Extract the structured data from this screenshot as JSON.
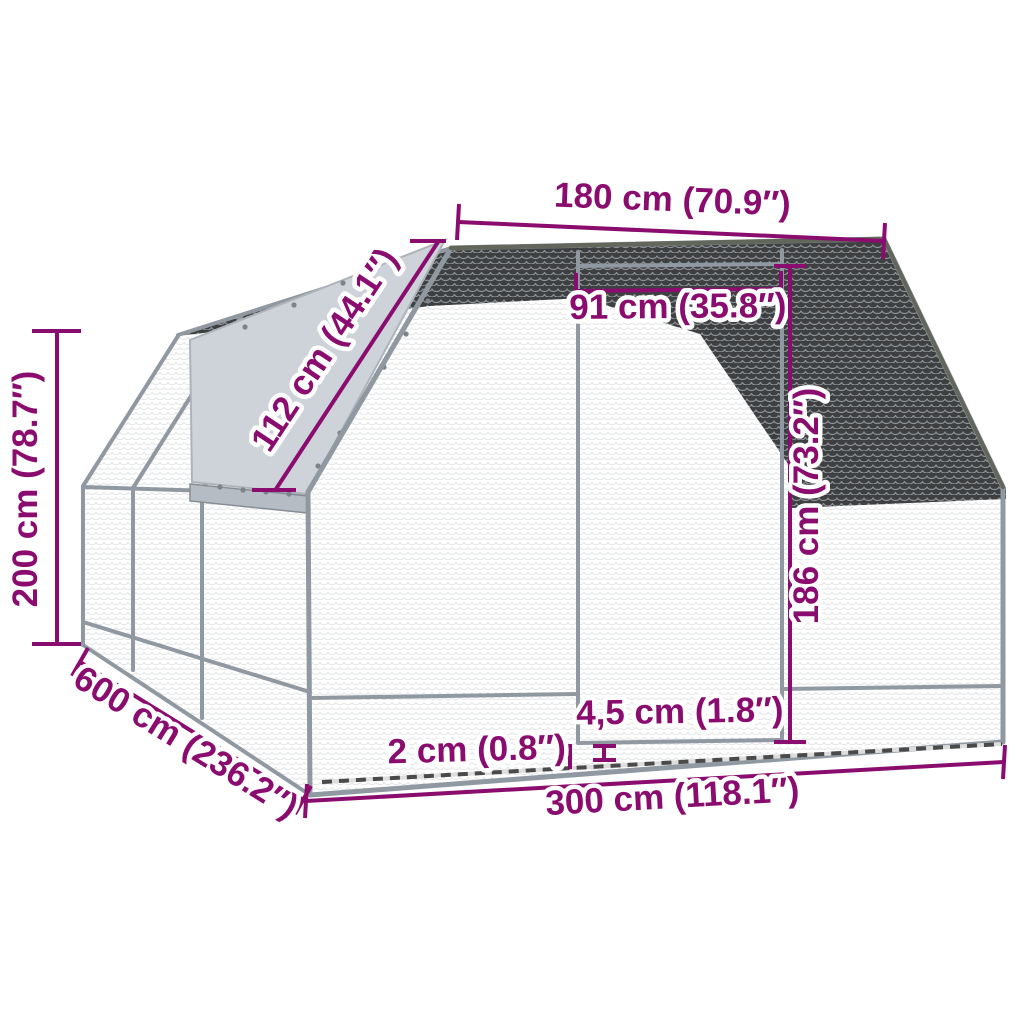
{
  "page": {
    "background": "#ffffff"
  },
  "diagram": {
    "subject": "outdoor chicken cage dimension drawing",
    "colors": {
      "accent": "#8A0C6E",
      "halo": "#ffffff",
      "frame": "#9099A1",
      "frame_dark": "#63665A",
      "roof_mesh": "#3E3F41",
      "roof_mesh_highlight": "#9aa0a4",
      "wall_mesh_line": "#e3e5e7",
      "tarp": "#ced3da",
      "tarp_rail": "#b6bcc4",
      "interior": "#c6cacd"
    },
    "dimensions": {
      "top_width": "180 cm (70.9″)",
      "door_width": "91 cm (35.8″)",
      "roof_slope": "112 cm (44.1″)",
      "height": "200 cm (78.7″)",
      "depth": "600 cm (236.2″)",
      "door_height": "186 cm (73.2″)",
      "bottom_gap": "4,5 cm (1.8″)",
      "frame_gap": "2 cm (0.8″)",
      "front_width": "300 cm (118.1″)"
    }
  }
}
